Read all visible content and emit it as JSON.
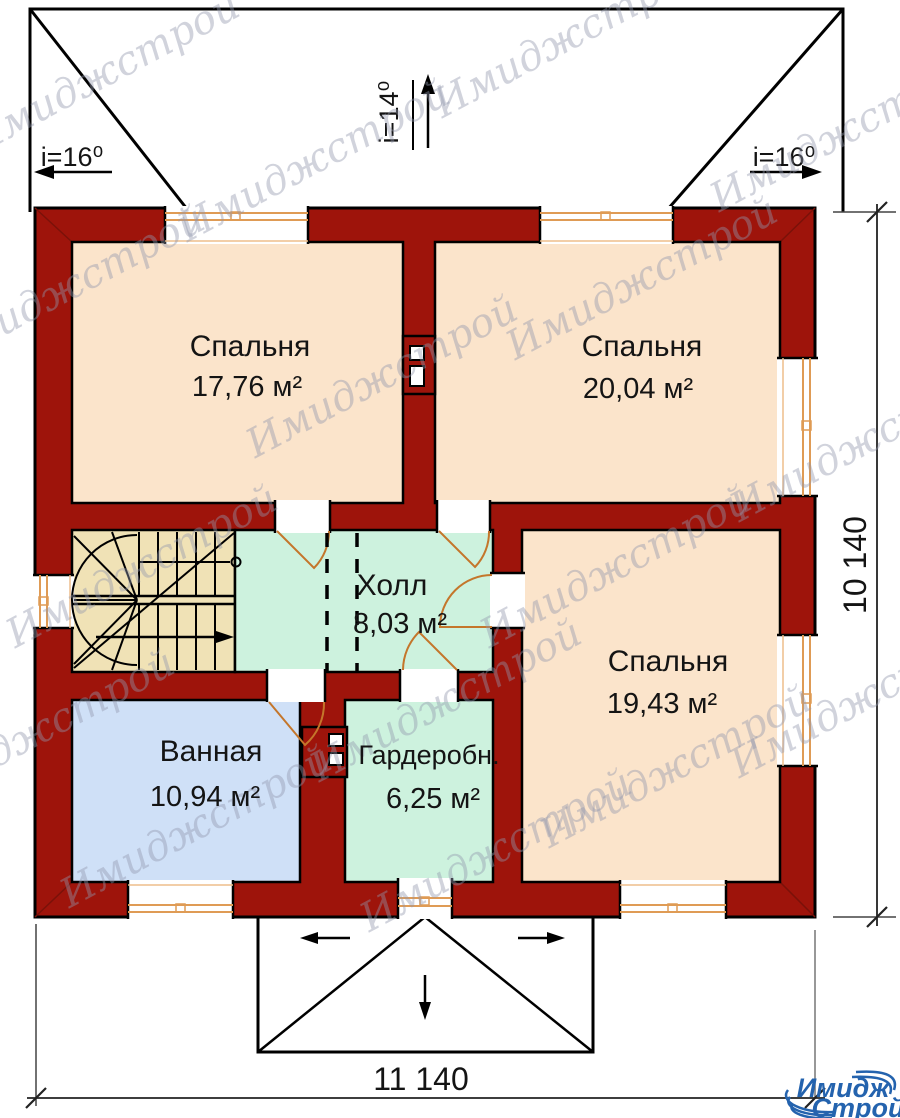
{
  "watermark": {
    "text": "Имиджстрой"
  },
  "rooms": [
    {
      "name": "Спальня",
      "area": "17,76 м²"
    },
    {
      "name": "Спальня",
      "area": "20,04 м²"
    },
    {
      "name": "Спальня",
      "area": "19,43 м²"
    },
    {
      "name": "Холл",
      "area": "8,03 м²"
    },
    {
      "name": "Ванная",
      "area": "10,94 м²"
    },
    {
      "name": "Гардеробн.",
      "area": "6,25 м²"
    }
  ],
  "roof": {
    "left_slope": "i=16⁰",
    "top_slope": "i=14⁰",
    "right_slope": "i=16⁰"
  },
  "dimensions": {
    "width": "11 140",
    "depth": "10 140"
  },
  "logo": {
    "top": "Имидж",
    "bottom": "Строй"
  },
  "colors": {
    "wall_red": "#9e140b",
    "bedroom_fill": "#fbe4cb",
    "hall_fill": "#cdf2de",
    "bath_fill": "#cfe0f7",
    "stairs_fill": "#f0e2b6",
    "door_orange": "#c4762b",
    "window_frame_orange": "#df9b55",
    "logo_blue": "#2463ae"
  }
}
